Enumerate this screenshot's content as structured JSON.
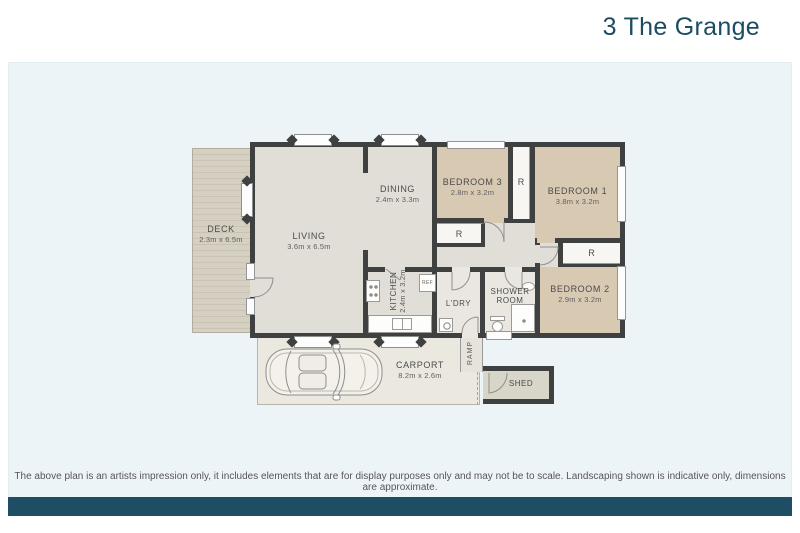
{
  "title": "3 The Grange",
  "colors": {
    "accent_teal": "#1d4e63",
    "title_teal": "#1b4c61",
    "panel_blue": "#edf4f8",
    "wall": "#3f4040",
    "bedroom_tan": "#d8c9b3",
    "floor_gray": "#e0ded6",
    "deck_tan": "#d6d0c2",
    "carport_cream": "#eae8df"
  },
  "plan": {
    "deck": {
      "name": "DECK",
      "dims": "2.3m x 6.5m"
    },
    "living": {
      "name": "LIVING",
      "dims": "3.6m x 6.5m"
    },
    "dining": {
      "name": "DINING",
      "dims": "2.4m x 3.3m"
    },
    "bedroom3": {
      "name": "BEDROOM 3",
      "dims": "2.8m x 3.2m"
    },
    "bedroom1": {
      "name": "BEDROOM 1",
      "dims": "3.8m x 3.2m"
    },
    "bedroom2": {
      "name": "BEDROOM 2",
      "dims": "2.9m x 3.2m"
    },
    "kitchen": {
      "name": "KITCHEN",
      "dims": "2.4m x 3.2m"
    },
    "laundry": {
      "name": "L'DRY"
    },
    "shower": {
      "name": "SHOWER ROOM"
    },
    "ramp": {
      "name": "RAMP"
    },
    "carport": {
      "name": "CARPORT",
      "dims": "8.2m x 2.6m"
    },
    "shed": {
      "name": "SHED"
    },
    "robe": "R",
    "fridge": "REF"
  },
  "footer": {
    "disclaimer": "The above plan is an artists impression only, it includes elements that are for display purposes only and may not be to scale. Landscaping shown is indicative only, dimensions are approximate."
  }
}
